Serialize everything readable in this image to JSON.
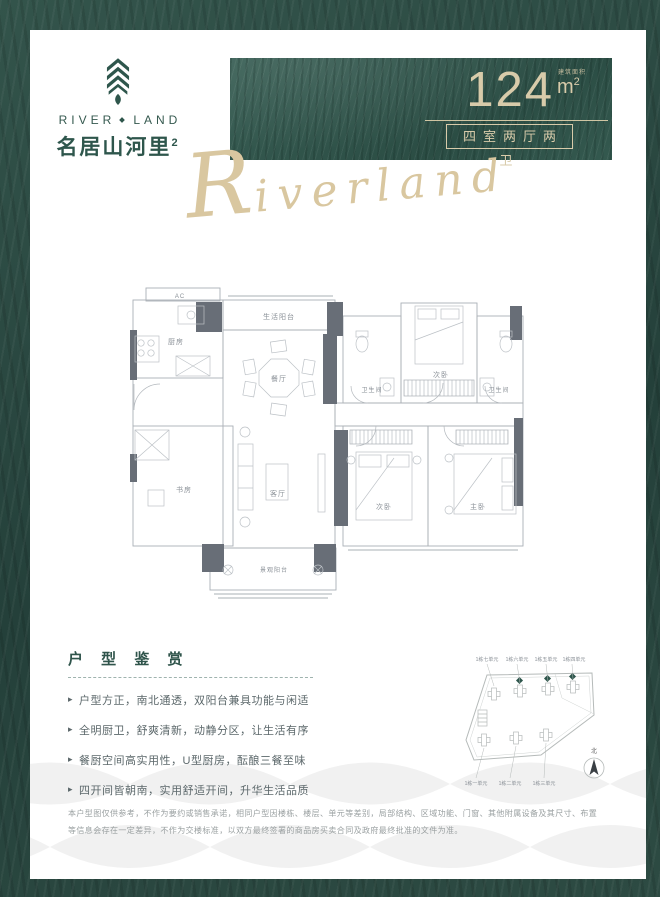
{
  "brand": {
    "name_en_left": "RIVER",
    "name_en_right": "LAND",
    "name_cn": "名居山河里",
    "name_cn_sup": "2"
  },
  "header": {
    "area_value": "124",
    "area_note": "建筑面积",
    "area_unit": "m",
    "area_sup": "2",
    "layout_label": "四室两厅两卫",
    "script": "Riverland"
  },
  "floorplan": {
    "rooms": {
      "ac": "AC",
      "kitchen": "厨房",
      "service_balcony": "生活阳台",
      "dining": "餐厅",
      "bath1": "卫生间",
      "bedroom2_top": "次卧",
      "bath2": "卫生间",
      "study": "书房",
      "living": "客厅",
      "bedroom2": "次卧",
      "master": "主卧",
      "view_balcony": "景观阳台"
    }
  },
  "appreciation": {
    "title": "户 型 鉴 赏",
    "bullet_icon": "▸",
    "bullets": [
      "户型方正，南北通透，双阳台兼具功能与闲适",
      "全明厨卫，舒爽清新，动静分区，让生活有序",
      "餐厨空间高实用性，U型厨房，酝酿三餐至味",
      "四开间皆朝南，实用舒适开间，升华生活品质"
    ]
  },
  "siteplan": {
    "top_labels": [
      "1栋七单元",
      "1栋六单元",
      "1栋五单元",
      "1栋四单元"
    ],
    "bottom_labels": [
      "1栋一单元",
      "1栋二单元",
      "1栋三单元"
    ],
    "compass_label": "北"
  },
  "disclaimer": "本户型图仅供参考，不作为要约或销售承诺，相同户型因楼栋、楼层、单元等差别，局部结构、区域功能、门窗、其他附属设备及其尺寸、布置等信息会存在一定差异，不作为交楼标准，以双方最终签署的商品房买卖合同及政府最终批准的文件为准。",
  "colors": {
    "frame_green": "#2a473f",
    "panel_green": "#33564d",
    "brand_green": "#2e564c",
    "gold": "#d8cbaa",
    "plan_wall": "#686e77",
    "plan_line": "#aab0b6"
  }
}
